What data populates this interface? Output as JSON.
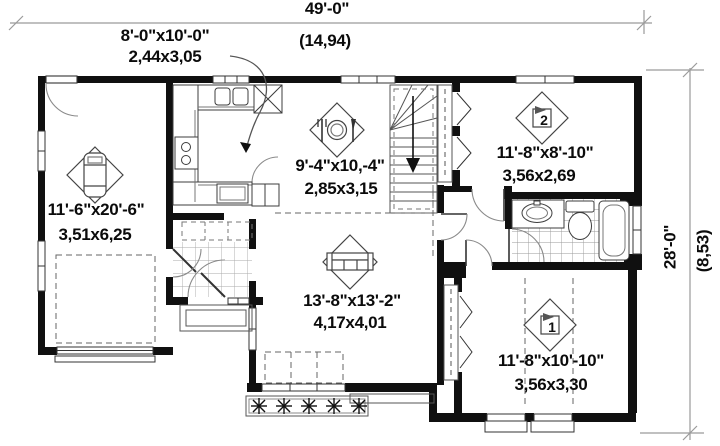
{
  "plan_title": "single-storey house floor plan",
  "dimensions": {
    "top": {
      "imperial": "49'-0\"",
      "metric": "(14,94)"
    },
    "right": {
      "imperial": "28'-0\"",
      "metric": "(8,53)"
    }
  },
  "rooms": {
    "kitchen": {
      "imperial": "8'-0\"x10'-0\"",
      "metric": "2,44x3,05"
    },
    "garage": {
      "imperial": "11'-6\"x20'-6\"",
      "metric": "3,51x6,25"
    },
    "dining": {
      "imperial": "9'-4\"x10,-4\"",
      "metric": "2,85x3,15"
    },
    "living": {
      "imperial": "13'-8\"x13'-2\"",
      "metric": "4,17x4,01"
    },
    "bedroom2": {
      "imperial": "11'-8\"x8'-10\"",
      "metric": "3,56x2,69",
      "number": "2"
    },
    "bedroom1": {
      "imperial": "11'-8\"x10'-10\"",
      "metric": "3,56x3,30",
      "number": "1"
    }
  },
  "icons": [
    "car-icon",
    "dining-icon",
    "sofa-icon",
    "bed-1-icon",
    "bed-2-icon",
    "sink-icon",
    "toilet-icon",
    "bathtub-icon",
    "stove-icon",
    "plant-icon"
  ],
  "colors": {
    "wall": "#101010",
    "fixture_line": "#3c3c3c",
    "door_arc": "#8a8a8a",
    "dimension_line": "#9a9a9a",
    "tile_line": "#aaaaaa",
    "background": "#ffffff",
    "text": "#0b0b0b"
  }
}
